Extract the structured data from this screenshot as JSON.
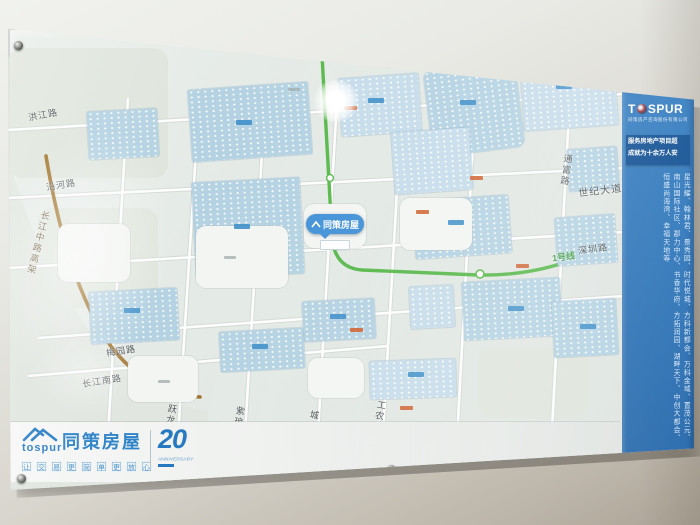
{
  "sidebar": {
    "brand_left": "T",
    "brand_right": "SPUR",
    "brand_sub": "同策房产咨询股份有限公司",
    "banner_line1": "服务房地产项目超",
    "banner_line2": "成就为十余万人安",
    "projects": "星光耀、翰林君、景秀园、时代悦城、方科新都会、万科金域、置茂公元、南山国际社区、郡力中心、书香华府、方拓润园、湖畔天下、中创大都会、恒盛尚海湾、幸福天地等"
  },
  "footer": {
    "brand_en": "tospur",
    "brand_cn": "同策房屋",
    "tagline_boxes": [
      "让",
      "交",
      "易",
      "更",
      "简",
      "单",
      "更",
      "放",
      "心"
    ],
    "anniversary_number": "20",
    "anniversary_text": "ANNIVERSARY"
  },
  "map": {
    "roads": [
      {
        "name": "洪江路"
      },
      {
        "name": "沿河路"
      },
      {
        "name": "长江中路高架"
      },
      {
        "name": "梅园路"
      },
      {
        "name": "长江南路"
      },
      {
        "name": "跃龙路"
      },
      {
        "name": "紫琅路"
      },
      {
        "name": "城山路"
      },
      {
        "name": "工农南路"
      },
      {
        "name": "通富路"
      },
      {
        "name": "世纪大道"
      },
      {
        "name": "深圳路"
      }
    ],
    "metro_label": "1号线",
    "store_marker": "同策房屋"
  },
  "colors": {
    "brand_blue": "#2b7fc4",
    "sidebar_blue": "#2e77bc",
    "metro_green": "#57b84a",
    "elevated_brown": "#a0722a",
    "block_blue": "#b4d2e2"
  }
}
